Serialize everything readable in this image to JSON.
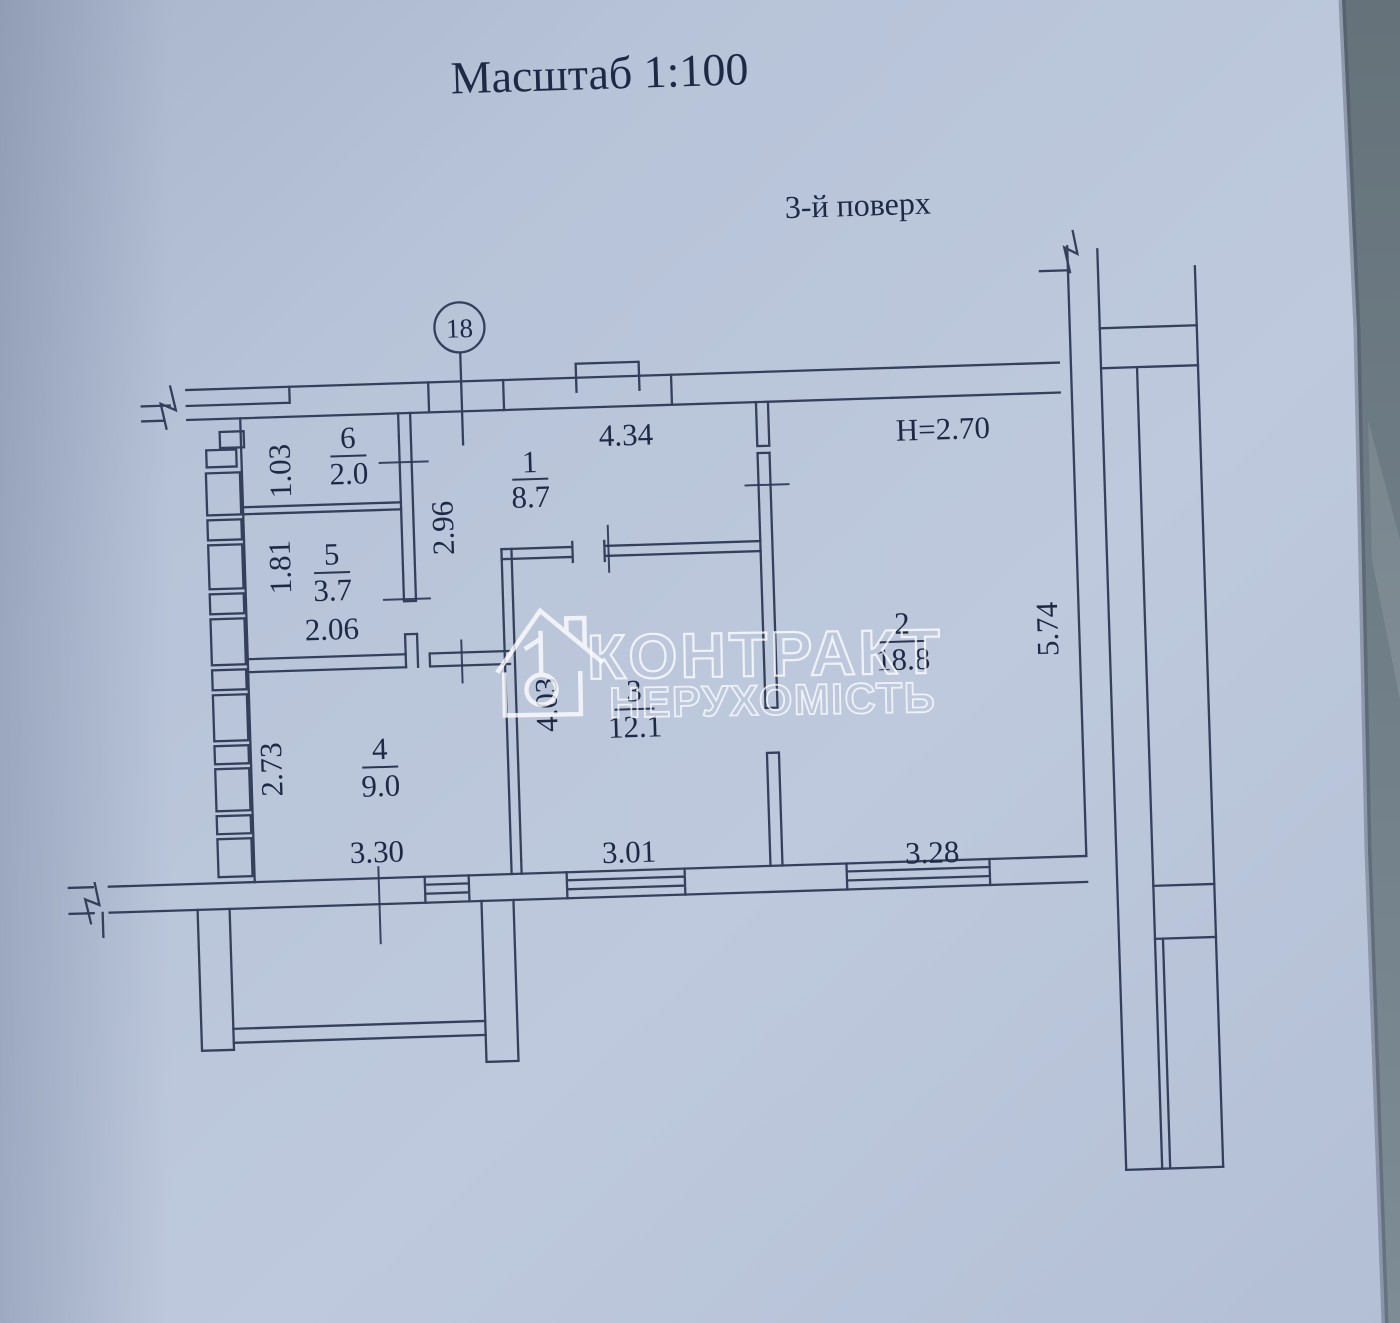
{
  "document": {
    "title": "Масштаб 1:100",
    "floor_label": "3-й поверх",
    "column_marker": "18",
    "height_note": "H=2.70"
  },
  "watermark": {
    "line1": "КОНТРАКТ",
    "line2": "НЕРУХОМІСТЬ"
  },
  "rooms": [
    {
      "number": "1",
      "area": "8.7"
    },
    {
      "number": "2",
      "area": "18.8"
    },
    {
      "number": "3",
      "area": "12.1"
    },
    {
      "number": "4",
      "area": "9.0"
    },
    {
      "number": "5",
      "area": "3.7"
    },
    {
      "number": "6",
      "area": "2.0"
    }
  ],
  "dimensions": {
    "hall_width": "4.34",
    "room6_depth": "1.03",
    "room5_depth": "1.81",
    "room5_width": "2.06",
    "hall_depth": "2.96",
    "room3_depth": "4.03",
    "room4_depth": "2.73",
    "room2_depth": "5.74",
    "room4_width": "3.30",
    "room3_width": "3.01",
    "room2_width": "3.28"
  },
  "colors": {
    "paper": "#b7c3d8",
    "ink": "#2b3652",
    "photo_background": "#6e7b85",
    "watermark": "#ffffff"
  }
}
